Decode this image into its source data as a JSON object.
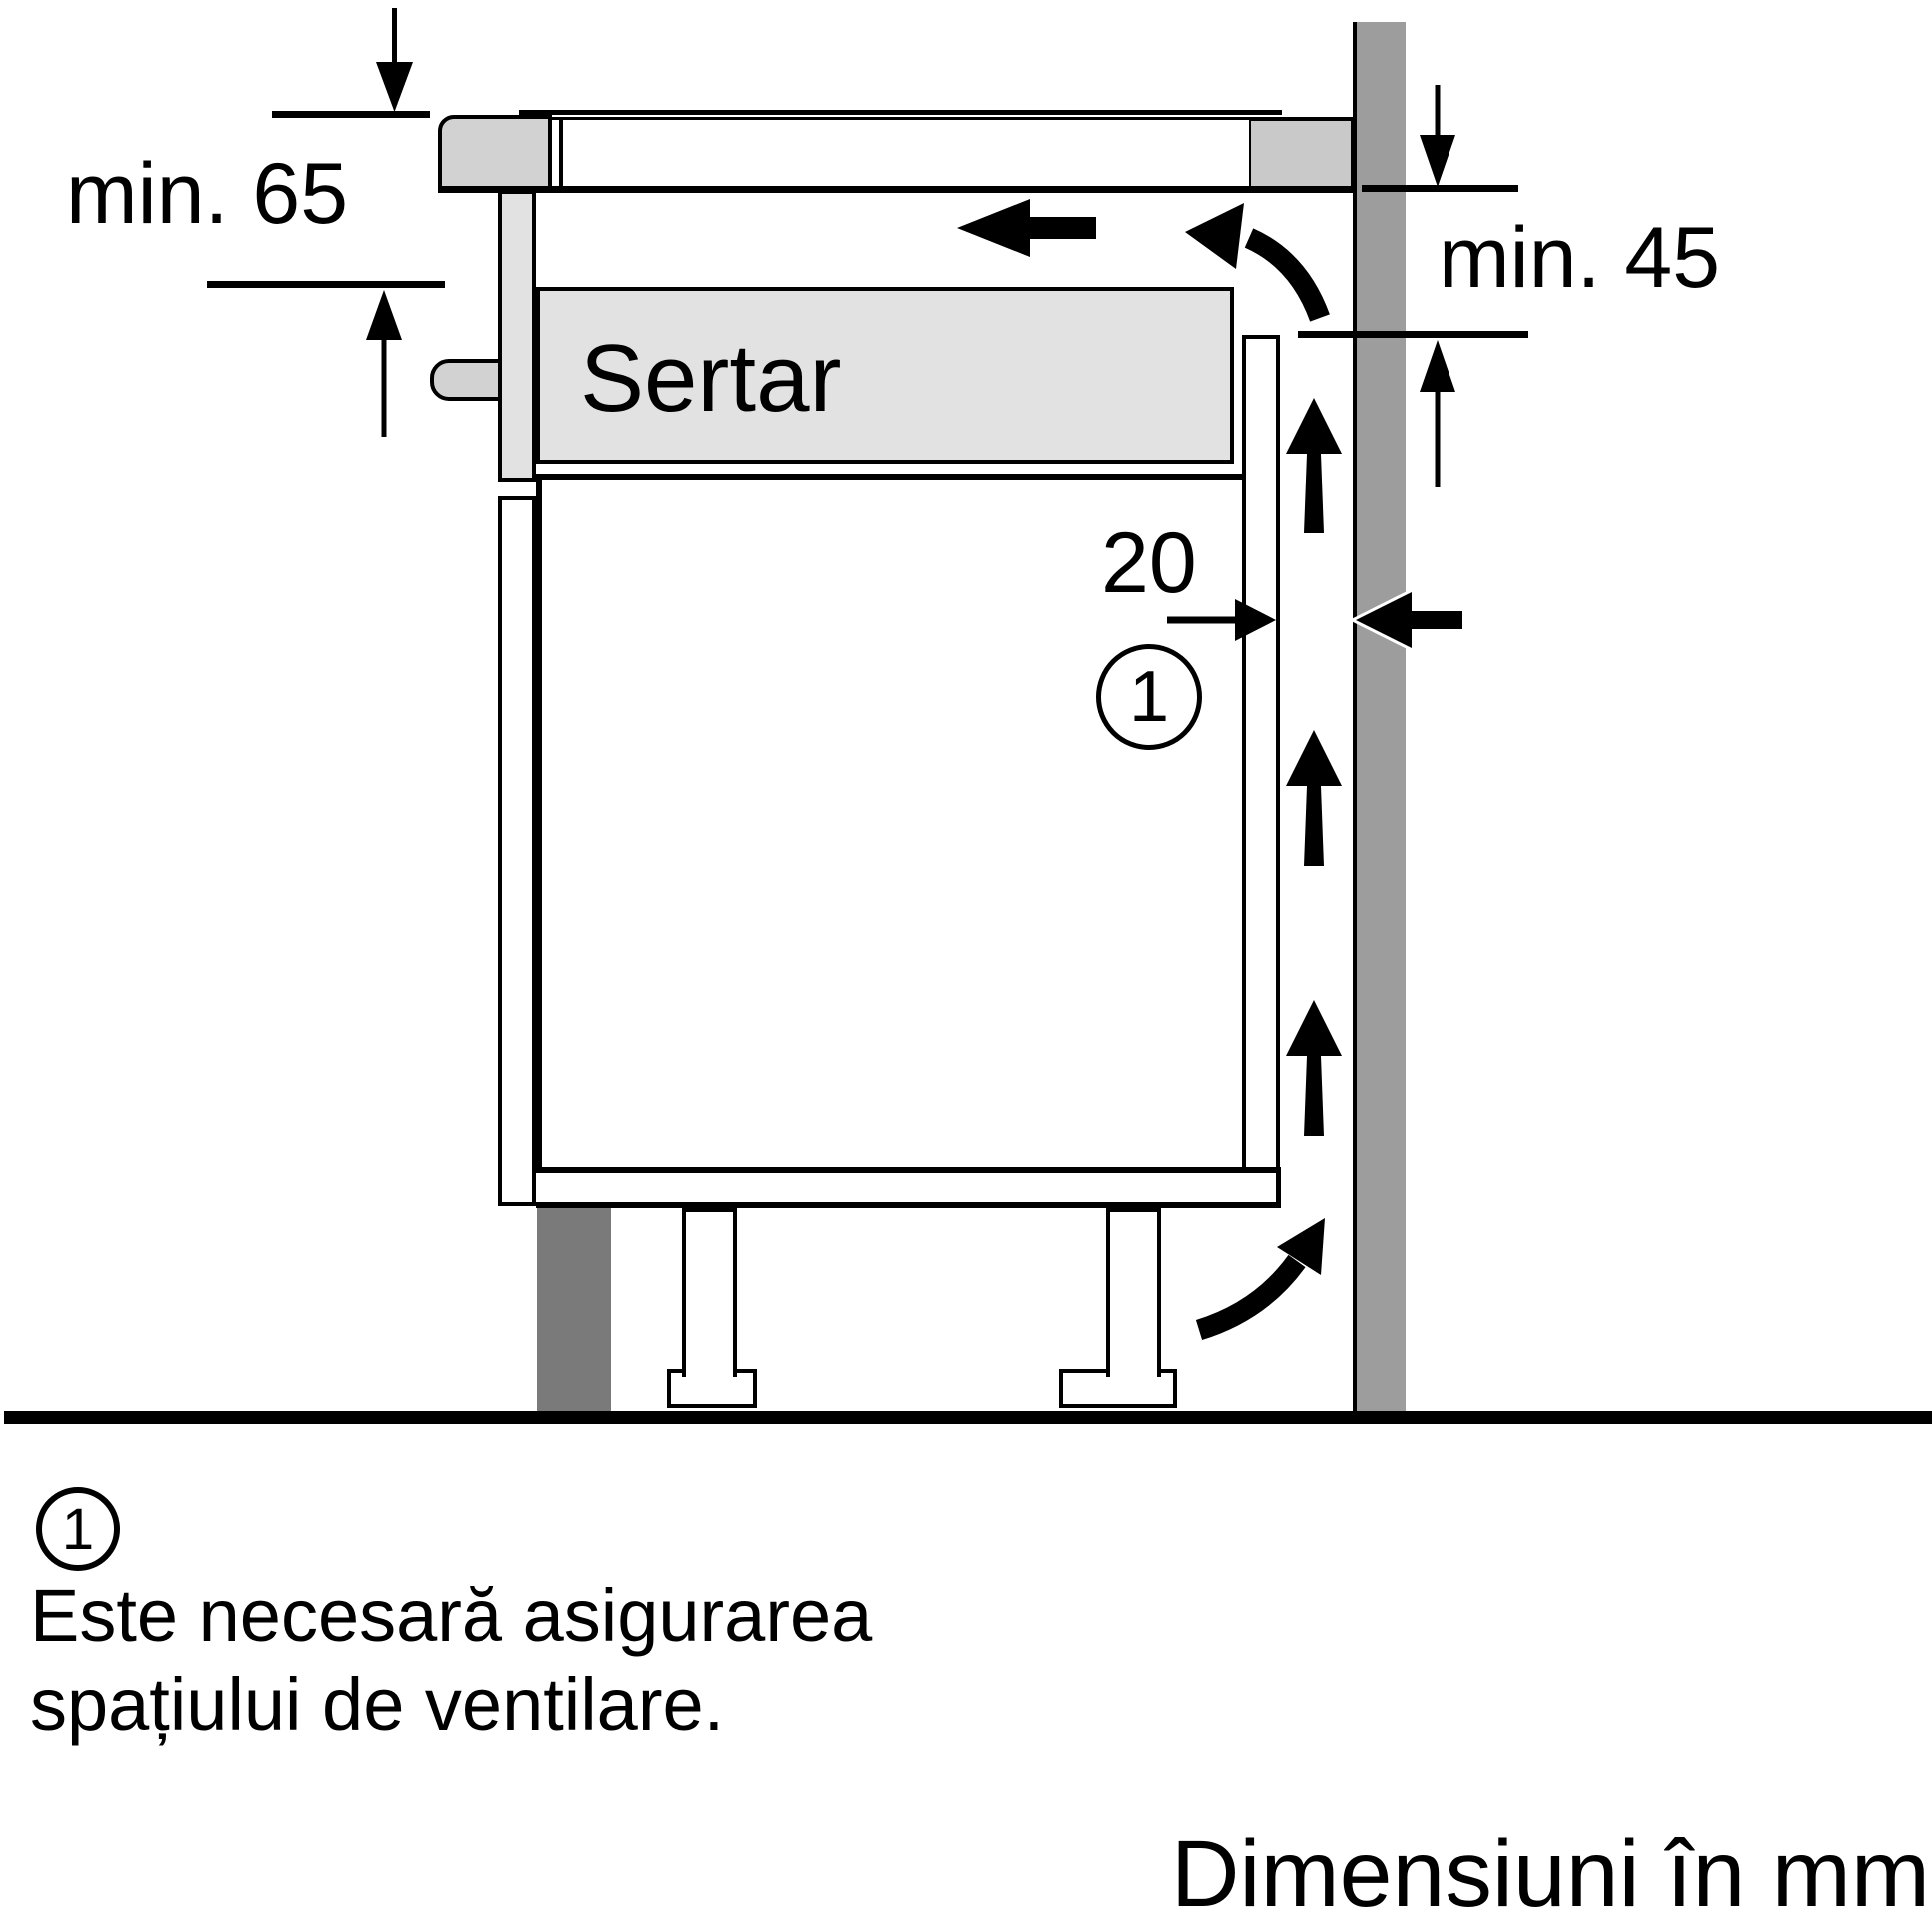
{
  "diagram": {
    "drawer_label": "Sertar",
    "dim_min_left": "min. 65",
    "dim_min_right": "min. 45",
    "dim_gap": "20",
    "callout": "1"
  },
  "legend": {
    "callout": "1",
    "line1": "Este necesară asigurarea",
    "line2": "spațiului de ventilare."
  },
  "caption": {
    "text": "Dimensiuni în mm"
  },
  "colors": {
    "wall": "#9d9d9d",
    "panel_light": "#e2e2e2",
    "hob_trim": "#d2d2d2",
    "worktop_block": "#c9c9c9",
    "plinth": "#7a7a7a",
    "line": "#000000"
  }
}
